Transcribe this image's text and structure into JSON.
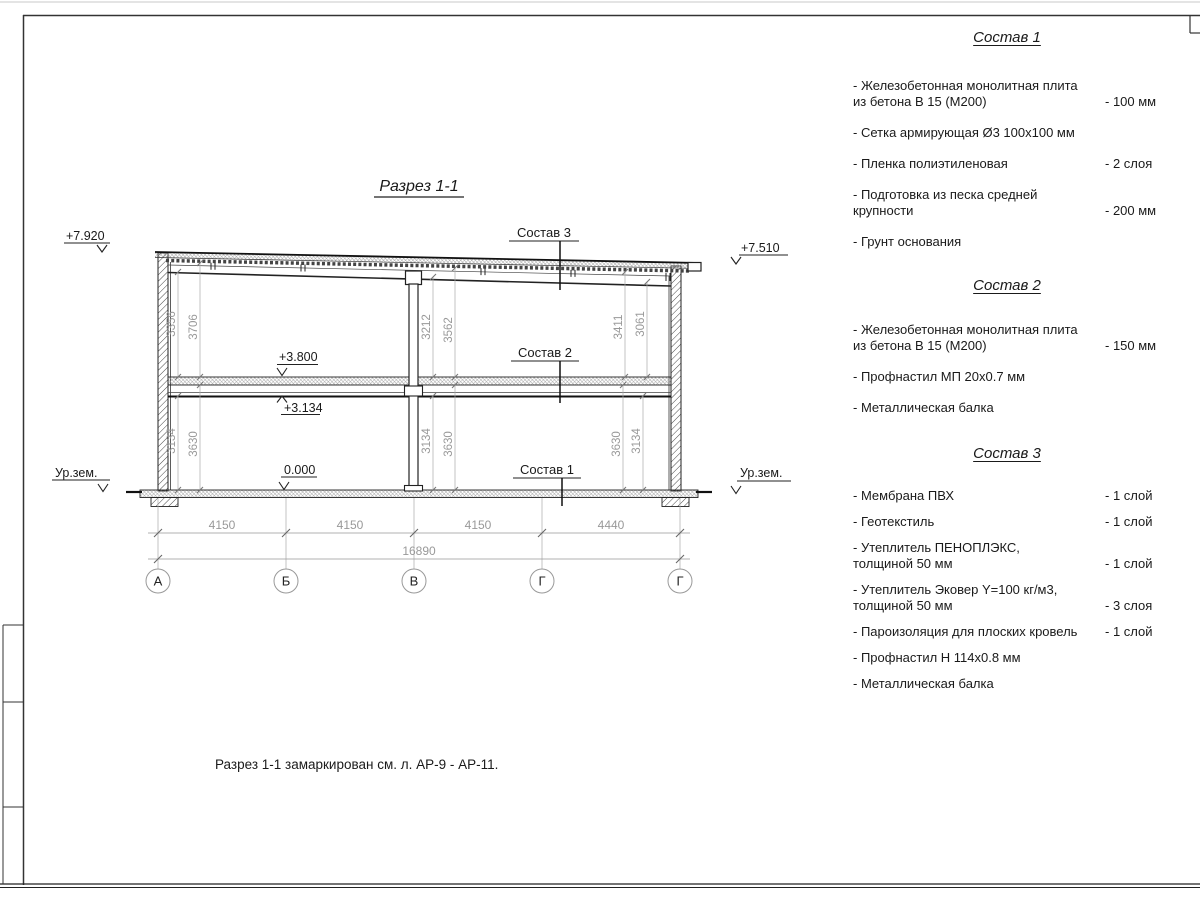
{
  "note": "Разрез 1-1 замаркирован см. л. АР-9 - АР-11.",
  "sections": [
    {
      "title": "Состав 1",
      "items": [
        {
          "name": "Железобетонная  монолитная плита\nиз бетона В 15 (М200)",
          "value": "- 100 мм"
        },
        {
          "name": "Сетка армирующая Ø3 100х100 мм",
          "value": ""
        },
        {
          "name": "Пленка полиэтиленовая",
          "value": "- 2 слоя"
        },
        {
          "name": "Подготовка из песка средней\nкрупности",
          "value": "- 200 мм"
        },
        {
          "name": "Грунт основания",
          "value": ""
        }
      ]
    },
    {
      "title": "Состав 2",
      "items": [
        {
          "name": "Железобетонная  монолитная плита\nиз бетона В 15 (М200)",
          "value": "- 150 мм"
        },
        {
          "name": "Профнастил МП 20х0.7 мм",
          "value": ""
        },
        {
          "name": "Металлическая балка",
          "value": ""
        }
      ]
    },
    {
      "title": "Состав 3",
      "items": [
        {
          "name": "Мембрана ПВХ",
          "value": "- 1 слой"
        },
        {
          "name": "Геотекстиль",
          "value": "- 1 слой"
        },
        {
          "name": "Утеплитель ПЕНОПЛЭКС,\nтолщиной 50 мм",
          "value": "- 1 слой"
        },
        {
          "name": "Утеплитель Эковер Y=100 кг/м3,\nтолщиной 50 мм",
          "value": "- 3 слоя"
        },
        {
          "name": "Пароизоляция для плоских кровель",
          "value": "- 1 слой"
        },
        {
          "name": "Профнастил Н 114х0.8 мм",
          "value": ""
        },
        {
          "name": "Металлическая балка",
          "value": ""
        }
      ]
    }
  ],
  "drawing": {
    "title": "Разрез 1-1",
    "elev_roof_left": "+7.920",
    "elev_roof_right": "+7.510",
    "elev_floor": "+3.800",
    "elev_beam": "+3.134",
    "elev_zero": "0.000",
    "ground_left": "Ур.зем.",
    "ground_right": "Ур.зем.",
    "leader_top": "Состав 3",
    "leader_mid": "Состав 2",
    "leader_bottom": "Состав 1",
    "dims_upper": [
      "3356",
      "3706",
      "3212",
      "3562",
      "3411",
      "3061"
    ],
    "dims_lower": [
      "3134",
      "3630",
      "3134",
      "3630",
      "3630",
      "3134"
    ],
    "dims_spans": [
      "4150",
      "4150",
      "4150",
      "4440"
    ],
    "dim_total": "16890",
    "axes": [
      "А",
      "Б",
      "В",
      "Г",
      "Г"
    ]
  }
}
